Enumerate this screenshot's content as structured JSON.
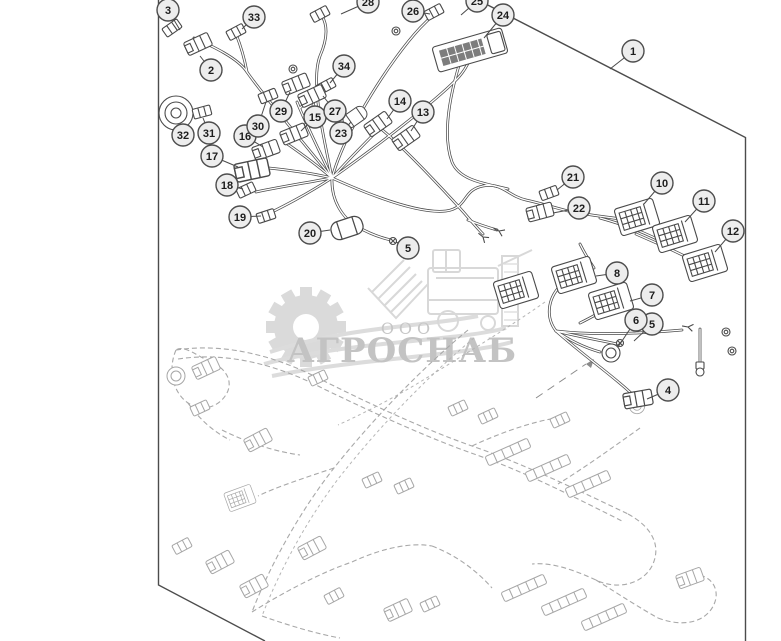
{
  "page": {
    "background": "#ffffff"
  },
  "watermark": {
    "org_type": "ООО",
    "name": "АГРОСНАБ",
    "gear_icon": "gear-icon",
    "vehicle_icon": "combine-harvester-icon",
    "color": "#c3c3c3"
  },
  "diagram": {
    "kind": "wiring-harness-parts-diagram",
    "colors": {
      "line": "#4a4a4a",
      "light_line": "#a6a6a6",
      "callout_fill": "#ededed",
      "callout_border": "#4d4d4d",
      "callout_text": "#1d1d1d",
      "background": "#ffffff"
    },
    "callouts": [
      {
        "label": "1",
        "x": 633,
        "y": 51,
        "tx": 610,
        "ty": 69
      },
      {
        "label": "2",
        "x": 211,
        "y": 70,
        "tx": 200,
        "ty": 56
      },
      {
        "label": "3",
        "x": 168,
        "y": 10,
        "tx": 180,
        "ty": 30
      },
      {
        "label": "4",
        "x": 668,
        "y": 390,
        "tx": 647,
        "ty": 399
      },
      {
        "label": "5",
        "x": 408,
        "y": 248,
        "tx": 396,
        "ty": 242
      },
      {
        "label": "5",
        "x": 652,
        "y": 324,
        "tx": 634,
        "ty": 341
      },
      {
        "label": "6",
        "x": 636,
        "y": 320,
        "tx": 618,
        "ty": 347
      },
      {
        "label": "7",
        "x": 652,
        "y": 295,
        "tx": 630,
        "ty": 301
      },
      {
        "label": "8",
        "x": 617,
        "y": 273,
        "tx": 596,
        "ty": 276
      },
      {
        "label": "10",
        "x": 662,
        "y": 183,
        "tx": 644,
        "ty": 204
      },
      {
        "label": "11",
        "x": 704,
        "y": 201,
        "tx": 685,
        "ty": 222
      },
      {
        "label": "12",
        "x": 733,
        "y": 231,
        "tx": 715,
        "ty": 252
      },
      {
        "label": "13",
        "x": 423,
        "y": 112,
        "tx": 411,
        "ty": 131
      },
      {
        "label": "14",
        "x": 400,
        "y": 101,
        "tx": 387,
        "ty": 119
      },
      {
        "label": "15",
        "x": 315,
        "y": 117,
        "tx": 301,
        "ty": 131
      },
      {
        "label": "16",
        "x": 245,
        "y": 136,
        "tx": 263,
        "ty": 147
      },
      {
        "label": "17",
        "x": 212,
        "y": 156,
        "tx": 238,
        "ty": 167
      },
      {
        "label": "18",
        "x": 227,
        "y": 185,
        "tx": 243,
        "ty": 189
      },
      {
        "label": "19",
        "x": 240,
        "y": 217,
        "tx": 261,
        "ty": 216
      },
      {
        "label": "20",
        "x": 310,
        "y": 233,
        "tx": 330,
        "ty": 230
      },
      {
        "label": "21",
        "x": 573,
        "y": 177,
        "tx": 557,
        "ty": 190
      },
      {
        "label": "22",
        "x": 579,
        "y": 208,
        "tx": 553,
        "ty": 213
      },
      {
        "label": "23",
        "x": 341,
        "y": 133,
        "tx": 351,
        "ty": 122
      },
      {
        "label": "24",
        "x": 503,
        "y": 15,
        "tx": 484,
        "ty": 38
      },
      {
        "label": "25",
        "x": 477,
        "y": 1,
        "tx": 461,
        "ty": 15
      },
      {
        "label": "26",
        "x": 413,
        "y": 11,
        "tx": 430,
        "ty": 14
      },
      {
        "label": "27",
        "x": 335,
        "y": 111,
        "tx": 323,
        "ty": 96
      },
      {
        "label": "28",
        "x": 368,
        "y": 2,
        "tx": 341,
        "ty": 14
      },
      {
        "label": "29",
        "x": 281,
        "y": 111,
        "tx": 290,
        "ty": 92
      },
      {
        "label": "30",
        "x": 258,
        "y": 126,
        "tx": 266,
        "ty": 102
      },
      {
        "label": "31",
        "x": 209,
        "y": 133,
        "tx": 203,
        "ty": 118
      },
      {
        "label": "32",
        "x": 183,
        "y": 135,
        "tx": 177,
        "ty": 126
      },
      {
        "label": "33",
        "x": 254,
        "y": 17,
        "tx": 242,
        "ty": 29
      },
      {
        "label": "34",
        "x": 344,
        "y": 66,
        "tx": 330,
        "ty": 83
      }
    ]
  }
}
